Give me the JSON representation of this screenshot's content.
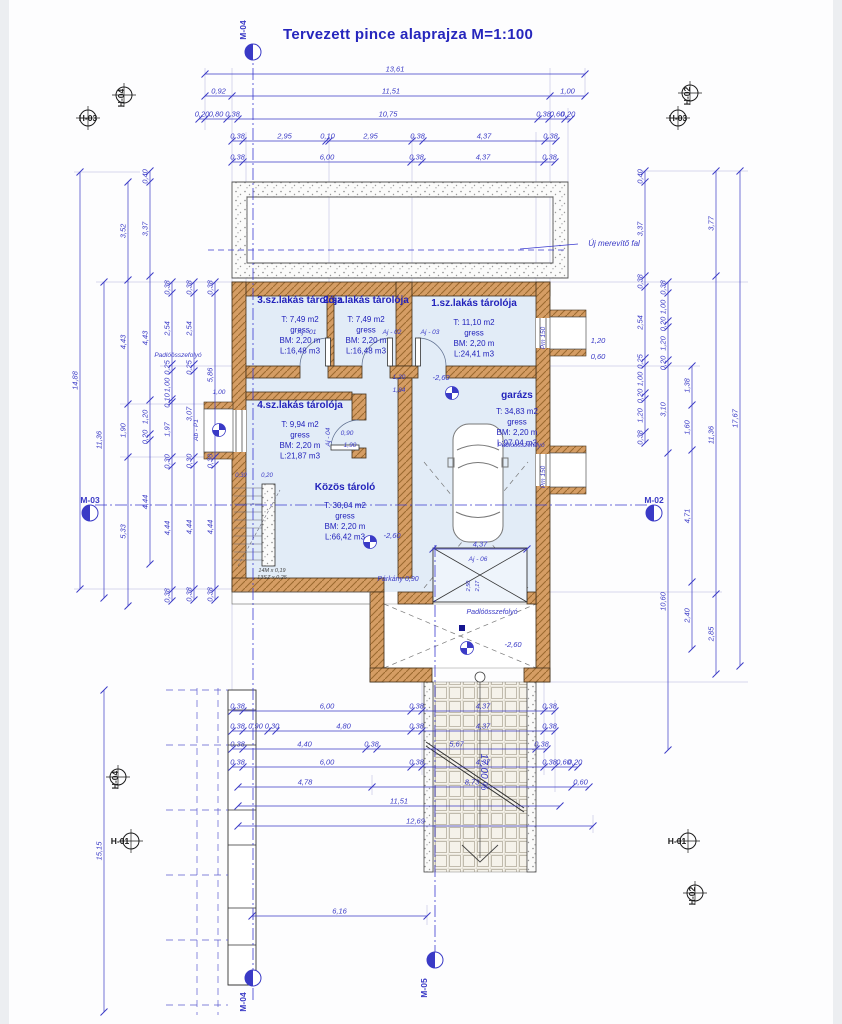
{
  "title": "Tervezett  pince alaprajza M=1:100",
  "colors": {
    "dim": "#3a3ac6",
    "room_text": "#2222bb",
    "wall": "#d59d64",
    "wall_edge": "#42301a",
    "room_fill": "#e2ecf7",
    "dark": "#444444",
    "black": "#1a1a1a"
  },
  "rooms": [
    {
      "name": "3.sz.lakás tárolója",
      "cx": 300,
      "ny": 303,
      "ly": 322,
      "lines": [
        "T: 7,49 m2",
        "gress",
        "BM: 2,20 m",
        "L:16,48 m3"
      ]
    },
    {
      "name": "2.sz.lakás tárolója",
      "cx": 366,
      "ny": 303,
      "ly": 322,
      "lines": [
        "T: 7,49 m2",
        "gress",
        "BM: 2,20 m",
        "L:16,48 m3"
      ]
    },
    {
      "name": "1.sz.lakás tárolója",
      "cx": 474,
      "ny": 306,
      "ly": 325,
      "lines": [
        "T: 11,10 m2",
        "gress",
        "BM: 2,20 m",
        "L:24,41 m3"
      ]
    },
    {
      "name": "4.sz.lakás tárolója",
      "cx": 300,
      "ny": 408,
      "ly": 427,
      "lines": [
        "T: 9,94 m2",
        "gress",
        "BM: 2,20 m",
        "L:21,87 m3"
      ]
    },
    {
      "name": "garázs",
      "cx": 517,
      "ny": 398,
      "ly": 414,
      "lines": [
        "T: 34,83 m2",
        "gress",
        "BM: 2,20 m",
        "L:97,04 m3"
      ]
    },
    {
      "name": "Közös tároló",
      "cx": 345,
      "ny": 490,
      "ly": 508,
      "lines": [
        "T: 30,04 m2",
        "gress",
        "BM: 2,20 m",
        "L:66,42 m3"
      ]
    }
  ],
  "chains": [
    {
      "o": "h",
      "pos": 74,
      "b": [
        205,
        585
      ],
      "l": [
        "13,61"
      ]
    },
    {
      "o": "h",
      "pos": 96,
      "b": [
        205,
        232,
        550,
        585
      ],
      "l": [
        "0,92",
        "11,51",
        "1,00"
      ]
    },
    {
      "o": "h",
      "pos": 119,
      "b": [
        199,
        205,
        227,
        238,
        538,
        549,
        565,
        571
      ],
      "l": [
        "0,20",
        "0,80",
        "0,38",
        "10,75",
        "0,38",
        "0,60",
        "0,20"
      ]
    },
    {
      "o": "h",
      "pos": 141,
      "b": [
        232,
        243,
        326,
        329,
        412,
        423,
        545,
        556
      ],
      "l": [
        "0,38",
        "2,95",
        "0,10",
        "2,95",
        "0,38",
        "4,37",
        "0,38"
      ]
    },
    {
      "o": "h",
      "pos": 162,
      "b": [
        232,
        243,
        411,
        422,
        544,
        555
      ],
      "l": [
        "0,38",
        "6,00",
        "0,38",
        "4,37",
        "0,38"
      ]
    },
    {
      "o": "h",
      "pos": 549,
      "b": [
        433,
        527
      ],
      "l": [
        "4,37"
      ]
    },
    {
      "o": "h",
      "pos": 711,
      "b": [
        232,
        243,
        411,
        422,
        544,
        555
      ],
      "l": [
        "0,38",
        "6,00",
        "0,38",
        "4,37",
        "0,38"
      ]
    },
    {
      "o": "h",
      "pos": 731,
      "b": [
        232,
        243,
        268,
        276,
        411,
        422,
        544,
        555
      ],
      "l": [
        "0,38",
        "0,90",
        "0,30",
        "4,80",
        "0,38",
        "4,37",
        "0,38"
      ]
    },
    {
      "o": "h",
      "pos": 749,
      "b": [
        232,
        243,
        366,
        377,
        536,
        547
      ],
      "l": [
        "0,38",
        "4,40",
        "0,38",
        "5,67",
        "0,38"
      ]
    },
    {
      "o": "h",
      "pos": 767,
      "b": [
        232,
        243,
        411,
        422,
        544,
        555,
        572,
        578
      ],
      "l": [
        "0,38",
        "6,00",
        "0,38",
        "4,37",
        "0,38",
        "0,60",
        "0,20"
      ]
    },
    {
      "o": "h",
      "pos": 787,
      "b": [
        238,
        372,
        572,
        589
      ],
      "l": [
        "4,78",
        "8,73",
        "0,60"
      ]
    },
    {
      "o": "h",
      "pos": 806,
      "b": [
        238,
        560
      ],
      "l": [
        "11,51"
      ]
    },
    {
      "o": "h",
      "pos": 826,
      "b": [
        238,
        593
      ],
      "l": [
        "12,69"
      ]
    },
    {
      "o": "h",
      "pos": 916,
      "b": [
        252,
        427
      ],
      "l": [
        "6,16"
      ]
    },
    {
      "o": "v",
      "pos": 80,
      "b": [
        172,
        589
      ],
      "l": [
        "14,88"
      ]
    },
    {
      "o": "v",
      "pos": 104,
      "b": [
        282,
        598
      ],
      "l": [
        "11,36"
      ]
    },
    {
      "o": "v",
      "pos": 104,
      "b": [
        690,
        1012
      ],
      "l": [
        "15,15"
      ]
    },
    {
      "o": "v",
      "pos": 128,
      "b": [
        182,
        280,
        404,
        457,
        606
      ],
      "l": [
        "3,52",
        "4,43",
        "1,90",
        "5,33"
      ]
    },
    {
      "o": "v",
      "pos": 150,
      "b": [
        171,
        182,
        276,
        400,
        434,
        440,
        564
      ],
      "l": [
        "0,40",
        "3,37",
        "4,43",
        "1,20",
        "0,20",
        "4,44"
      ]
    },
    {
      "o": "v",
      "pos": 172,
      "b": [
        282,
        293,
        364,
        371,
        399,
        402,
        457,
        466,
        590,
        601
      ],
      "l": [
        "0,38",
        "2,54",
        "0,25",
        "1,00",
        "0,10",
        "1,97",
        "0,30",
        "4,44",
        "0,38"
      ]
    },
    {
      "o": "v",
      "pos": 194,
      "b": [
        282,
        293,
        364,
        371,
        457,
        465,
        589,
        600
      ],
      "l": [
        "0,38",
        "2,54",
        "0,25",
        "3,07",
        "0,30",
        "4,44",
        "0,38"
      ]
    },
    {
      "o": "v",
      "pos": 215,
      "b": [
        282,
        293,
        457,
        465,
        589,
        600
      ],
      "l": [
        "0,38",
        "5,86",
        "0,30",
        "4,44",
        "0,38"
      ]
    },
    {
      "o": "v",
      "pos": 645,
      "b": [
        171,
        182,
        276,
        287,
        358,
        365,
        393,
        399,
        432,
        443
      ],
      "l": [
        "0,40",
        "3,37",
        "0,38",
        "2,54",
        "0,25",
        "1,00",
        "0,20",
        "1,20",
        "0,38"
      ]
    },
    {
      "o": "v",
      "pos": 668,
      "b": [
        282,
        293,
        321,
        327,
        360,
        366,
        453,
        750
      ],
      "l": [
        "0,38",
        "1,00",
        "0,20",
        "1,20",
        "0,20",
        "3,10",
        "10,60"
      ]
    },
    {
      "o": "v",
      "pos": 692,
      "b": [
        366,
        405,
        450,
        582,
        649
      ],
      "l": [
        "1,38",
        "1,60",
        "4,71",
        "2,40"
      ]
    },
    {
      "o": "v",
      "pos": 716,
      "b": [
        171,
        276,
        594,
        674
      ],
      "l": [
        "3,77",
        "11,36",
        "2,85"
      ]
    },
    {
      "o": "v",
      "pos": 740,
      "b": [
        171,
        666
      ],
      "l": [
        "17,67"
      ]
    }
  ],
  "labels": [
    {
      "t": "Új merevítő fal",
      "x": 614,
      "y": 246,
      "s": 8
    },
    {
      "t": "Padlóösszefolyó",
      "x": 178,
      "y": 357,
      "s": 6.5
    },
    {
      "t": "Padlóösszefolyó",
      "x": 521,
      "y": 447,
      "s": 6.5
    },
    {
      "t": "Padlóösszefolyó",
      "x": 492,
      "y": 614,
      "s": 7
    },
    {
      "t": "-2,60",
      "x": 441,
      "y": 380,
      "s": 7.5
    },
    {
      "t": "-2,60",
      "x": 392,
      "y": 538,
      "s": 7.5
    },
    {
      "t": "-2,60",
      "x": 513,
      "y": 647,
      "s": 7.5
    },
    {
      "t": "Párkány 0,90",
      "x": 398,
      "y": 581,
      "s": 7
    },
    {
      "t": "17,00 %",
      "x": 481,
      "y": 772,
      "s": 10,
      "r": 90
    },
    {
      "t": "Aj - 01",
      "x": 307,
      "y": 334,
      "s": 6.5
    },
    {
      "t": "Aj - 02",
      "x": 392,
      "y": 334,
      "s": 6.5
    },
    {
      "t": "Aj - 03",
      "x": 430,
      "y": 334,
      "s": 6.5
    },
    {
      "t": "Aj - 04",
      "x": 330,
      "y": 437,
      "s": 6.5,
      "r": -90
    },
    {
      "t": "Aj - 06",
      "x": 478,
      "y": 561,
      "s": 6.5
    },
    {
      "t": "Ab - P1",
      "x": 198,
      "y": 430,
      "s": 6.5,
      "r": -90
    },
    {
      "t": "Pm 150",
      "x": 545,
      "y": 338,
      "s": 6.5,
      "r": -90
    },
    {
      "t": "Pm 150",
      "x": 545,
      "y": 477,
      "s": 6.5,
      "r": -90
    },
    {
      "t": "1,20",
      "x": 598,
      "y": 343,
      "s": 7.5
    },
    {
      "t": "0,60",
      "x": 598,
      "y": 359,
      "s": 7.5
    },
    {
      "t": "1,20",
      "x": 399,
      "y": 379,
      "s": 6.5
    },
    {
      "t": "1,84",
      "x": 399,
      "y": 392,
      "s": 6.5
    },
    {
      "t": "0,90",
      "x": 347,
      "y": 435,
      "s": 6.5
    },
    {
      "t": "1,90",
      "x": 350,
      "y": 447,
      "s": 6.5
    },
    {
      "t": "1,00",
      "x": 219,
      "y": 394,
      "s": 6.5
    },
    {
      "t": "0,30",
      "x": 241,
      "y": 477,
      "s": 6
    },
    {
      "t": "0,20",
      "x": 267,
      "y": 477,
      "s": 6
    },
    {
      "t": "2,50",
      "x": 470,
      "y": 586,
      "s": 5.5,
      "r": -90
    },
    {
      "t": "2,17",
      "x": 479,
      "y": 586,
      "s": 5.5,
      "r": -90
    },
    {
      "t": "14M x 0,19",
      "x": 272,
      "y": 572,
      "s": 5.5,
      "c": "dark"
    },
    {
      "t": "13SZ x 0,25",
      "x": 272,
      "y": 579,
      "s": 5.5,
      "c": "dark"
    }
  ],
  "markers": [
    {
      "t": "M-04",
      "kind": "m",
      "x": 253,
      "y": 52,
      "lx": 246,
      "ly": 30,
      "lr": -90
    },
    {
      "t": "M-04",
      "kind": "m",
      "x": 253,
      "y": 978,
      "lx": 246,
      "ly": 1002,
      "lr": -90
    },
    {
      "t": "M-05",
      "kind": "m",
      "x": 435,
      "y": 960,
      "lx": 427,
      "ly": 988,
      "lr": -90
    },
    {
      "t": "M-03",
      "kind": "m",
      "x": 90,
      "y": 513,
      "lx": 90,
      "ly": 503,
      "lr": 0
    },
    {
      "t": "M-02",
      "kind": "m",
      "x": 654,
      "y": 513,
      "lx": 654,
      "ly": 503,
      "lr": 0
    },
    {
      "t": "H-04",
      "kind": "h",
      "x": 124,
      "y": 95,
      "lx": 124,
      "ly": 98,
      "lr": -90
    },
    {
      "t": "H-03",
      "kind": "h",
      "x": 88,
      "y": 118,
      "lx": 88,
      "ly": 121,
      "lr": 0
    },
    {
      "t": "H-02",
      "kind": "h",
      "x": 690,
      "y": 93,
      "lx": 690,
      "ly": 96,
      "lr": -90
    },
    {
      "t": "H-03",
      "kind": "h",
      "x": 678,
      "y": 118,
      "lx": 678,
      "ly": 121,
      "lr": 0
    },
    {
      "t": "H-04",
      "kind": "h",
      "x": 118,
      "y": 777,
      "lx": 118,
      "ly": 780,
      "lr": -90
    },
    {
      "t": "H-01",
      "kind": "h",
      "x": 131,
      "y": 841,
      "lx": 120,
      "ly": 844,
      "lr": 0
    },
    {
      "t": "H-01",
      "kind": "h",
      "x": 688,
      "y": 841,
      "lx": 677,
      "ly": 844,
      "lr": 0
    },
    {
      "t": "H-02",
      "kind": "h",
      "x": 695,
      "y": 893,
      "lx": 695,
      "ly": 896,
      "lr": -90
    }
  ],
  "symbols": [
    {
      "x": 452,
      "y": 393
    },
    {
      "x": 370,
      "y": 542
    },
    {
      "x": 467,
      "y": 648
    },
    {
      "x": 219,
      "y": 430
    }
  ],
  "drains": [
    {
      "x": 462,
      "y": 628
    }
  ]
}
